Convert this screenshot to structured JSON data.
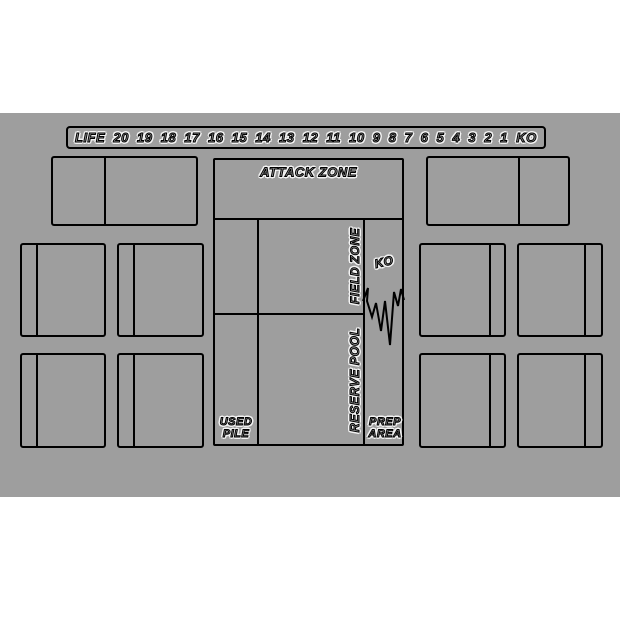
{
  "mat": {
    "background_color": "#9e9e9e",
    "line_color": "#000000",
    "text_glow_color": "#f2f2f2"
  },
  "life_track": {
    "label": "LIFE",
    "values": [
      "20",
      "19",
      "18",
      "17",
      "16",
      "15",
      "14",
      "13",
      "12",
      "11",
      "10",
      "9",
      "8",
      "7",
      "6",
      "5",
      "4",
      "3",
      "2",
      "1",
      "KO"
    ]
  },
  "zones": {
    "attack_zone": "ATTACK ZONE",
    "field_zone": "FIELD ZONE",
    "reserve_pool": "RESERVE POOL",
    "ko": "KO",
    "used_pile": "USED\nPILE",
    "prep_area": "PREP\nAREA"
  }
}
